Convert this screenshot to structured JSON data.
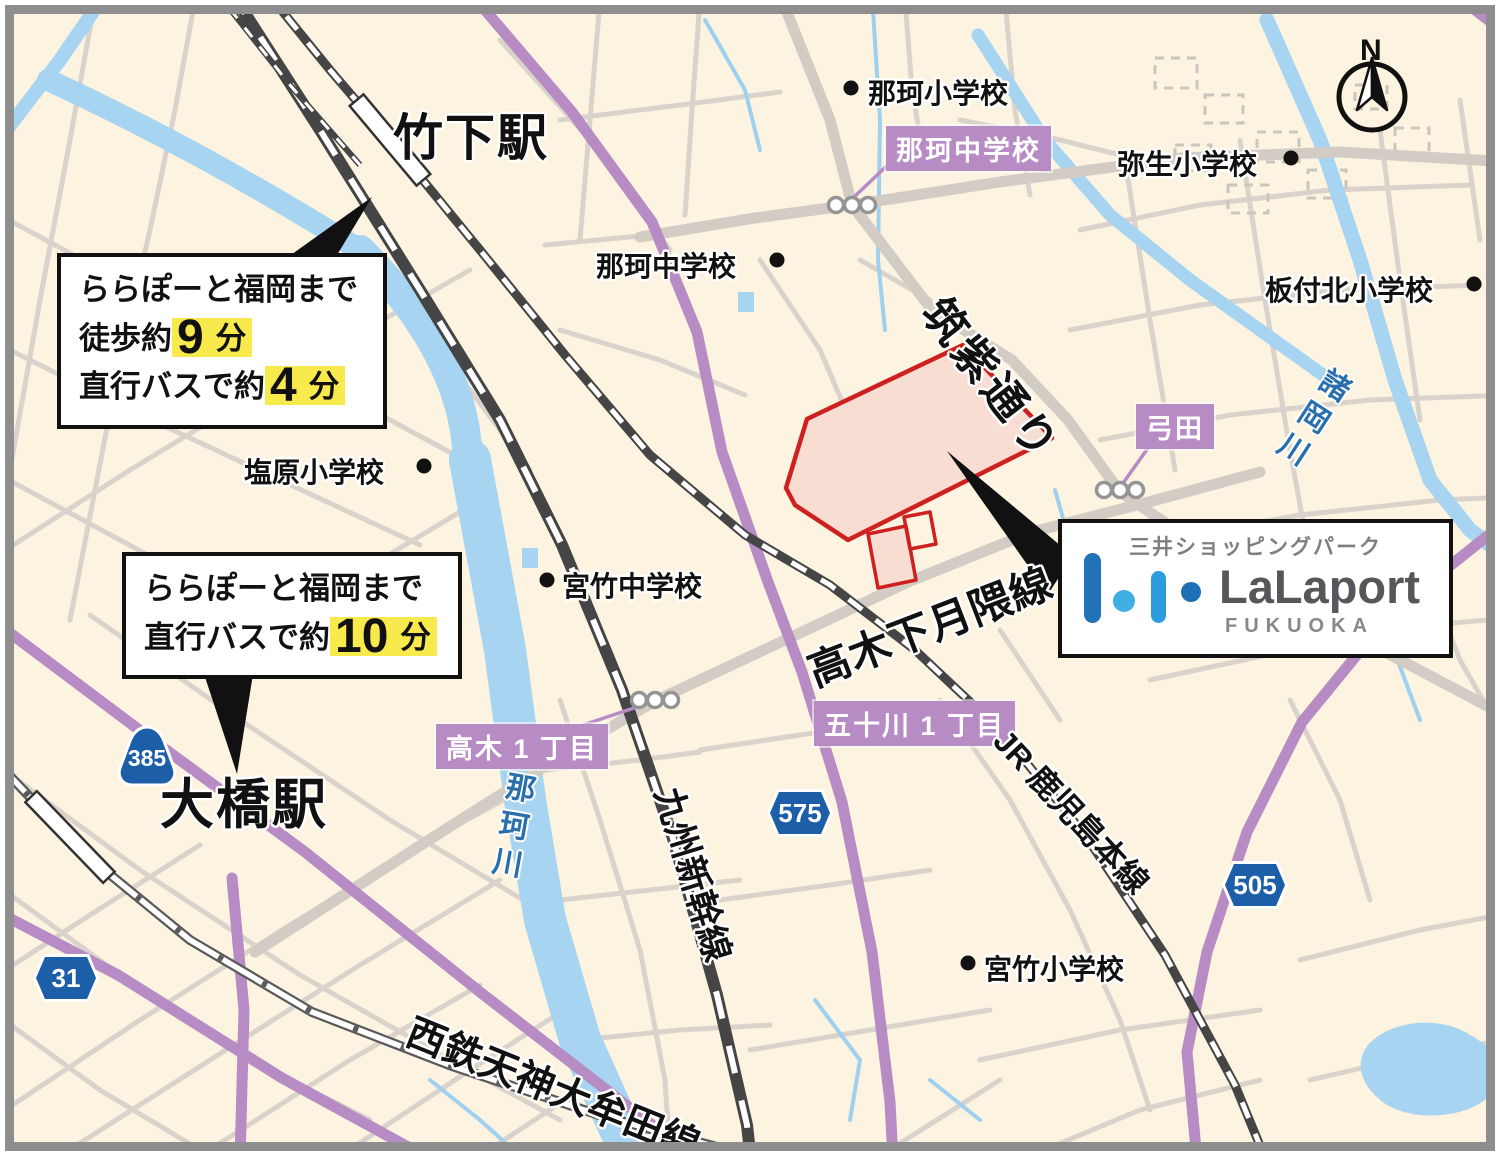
{
  "map": {
    "stations": {
      "takeshita": "竹下駅",
      "ohashi": "大橋駅"
    },
    "callout_takeshita": {
      "line1": "ららぽーと福岡まで",
      "walk_prefix": "徒歩約",
      "walk_value": "9",
      "walk_unit": "分",
      "bus_prefix": "直行バスで約",
      "bus_value": "4",
      "bus_unit": "分"
    },
    "callout_ohashi": {
      "line1": "ららぽーと福岡まで",
      "bus_prefix": "直行バスで約",
      "bus_value": "10",
      "bus_unit": "分"
    },
    "schools": {
      "naka_elem": "那珂小学校",
      "naka_jhs": "那珂中学校",
      "yayoi_elem": "弥生小学校",
      "itazukekita_elem": "板付北小学校",
      "shiobaru_elem": "塩原小学校",
      "miyatake_jhs": "宮竹中学校",
      "miyatake_elem": "宮竹小学校"
    },
    "bus_stops": {
      "naka_jhs": "那珂中学校",
      "yumita": "弓田",
      "takagi_1chome": "高木 1 丁目",
      "isogawa_1chome": "五十川 1 丁目"
    },
    "roads": {
      "chikushi_dori": "筑紫通り",
      "takagi_shimotsukiguma": "高木下月隈線"
    },
    "railways": {
      "kyushu_shinkansen": "九州新幹線",
      "jr_kagoshima_main_line": "JR 鹿児島本線",
      "nishitetsu_tenjin_omuta_line": "西鉄天神大牟田線"
    },
    "rivers": {
      "nakagawa": "那珂川",
      "morookagawa": "諸岡川"
    },
    "route_shields": {
      "r385": "385",
      "r31": "31",
      "r575": "575",
      "r505": "505"
    },
    "logo_box": {
      "tagline": "三井ショッピングパーク",
      "brand": "LaLaport",
      "location": "FUKUOKA"
    },
    "compass_label": "N",
    "colors": {
      "background_cream": "#fcf3e0",
      "site_border_red": "#cf2020",
      "site_fill_pink": "#f8ddd3",
      "route_shield_blue": "#1d5ea9",
      "bus_label_purple": "#b78bc3",
      "highlight_yellow": "#f8ea4d",
      "river_blue": "#a7d4f1",
      "logo_blue_dark": "#2273b8",
      "logo_blue_light": "#3fafe2"
    }
  }
}
